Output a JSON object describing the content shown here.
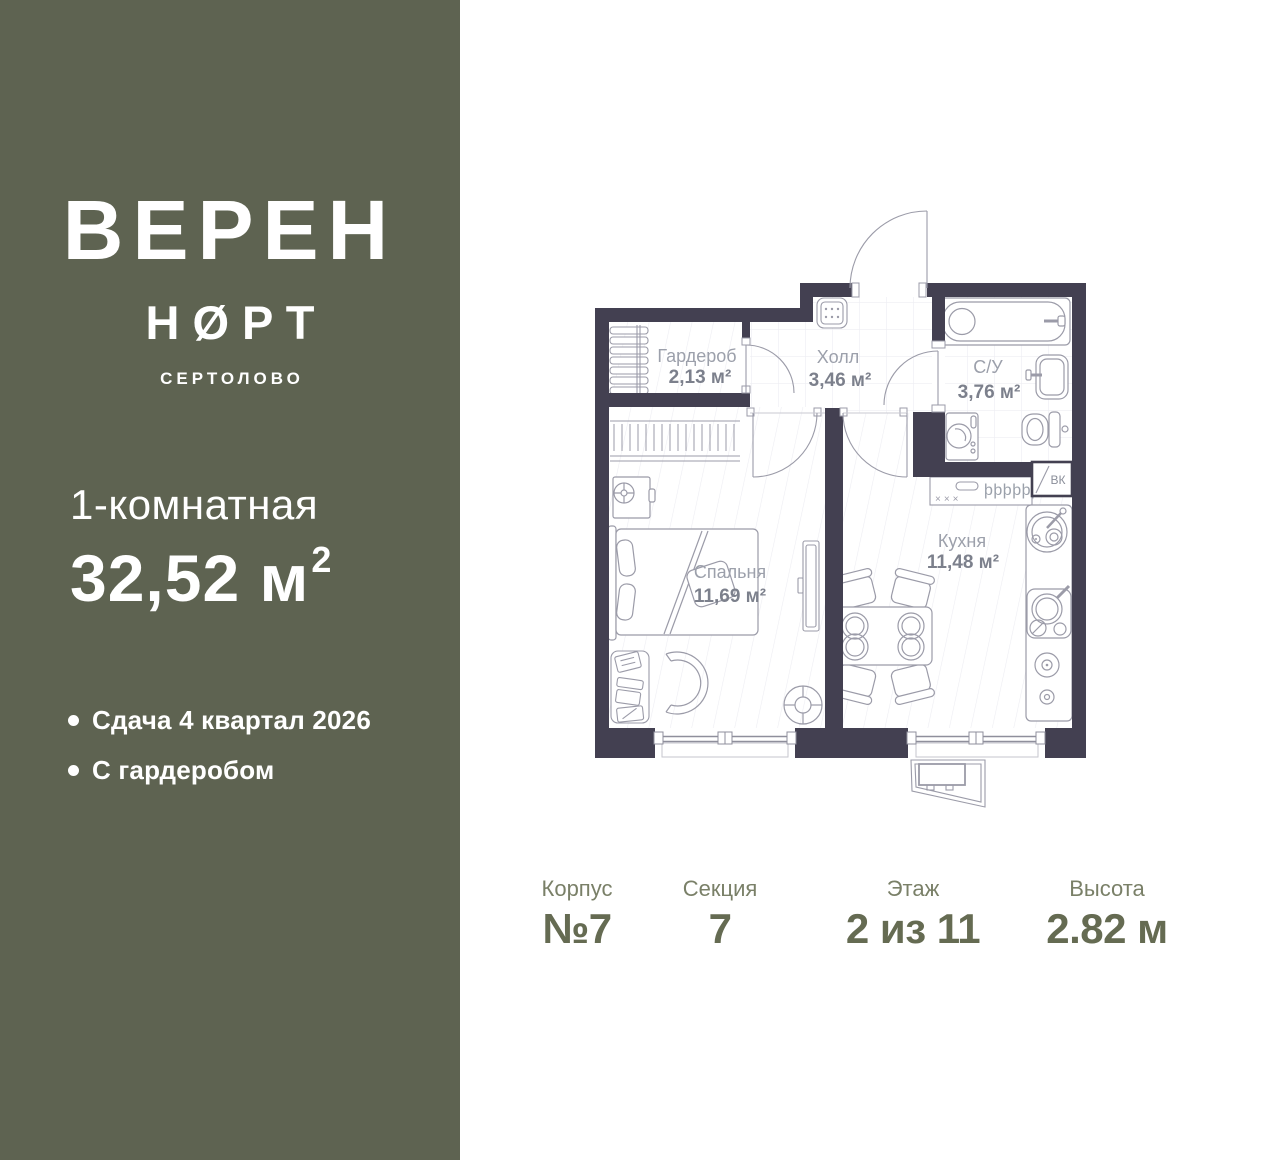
{
  "sidebar": {
    "brand_line1": "ВЕРЕН",
    "brand_line2": "НØРТ",
    "brand_city": "СЕРТОЛОВО",
    "apartment_type": "1-комнатная",
    "area_value": "32,52 м",
    "area_sup": "2",
    "features": [
      "Сдача 4 квартал 2026",
      "С гардеробом"
    ],
    "bg_color": "#5e6351"
  },
  "plan": {
    "rooms": [
      {
        "name": "Гардероб",
        "area": "2,13 м²"
      },
      {
        "name": "Холл",
        "area": "3,46 м²"
      },
      {
        "name": "С/У",
        "area": "3,76 м²"
      },
      {
        "name": "Спальня",
        "area": "11,69 м²"
      },
      {
        "name": "Кухня",
        "area": "11,48 м²"
      }
    ],
    "shaft_label": "ВК",
    "stove_marks": "×××",
    "vent_symbols": "þþþþþþ",
    "wall_color": "#434051",
    "line_color": "#9b9ba8"
  },
  "info": {
    "columns": [
      {
        "label": "Корпус",
        "value": "№7"
      },
      {
        "label": "Секция",
        "value": "7"
      },
      {
        "label": "Этаж",
        "value": "2 из 11"
      },
      {
        "label": "Высота",
        "value": "2.82 м"
      }
    ]
  }
}
